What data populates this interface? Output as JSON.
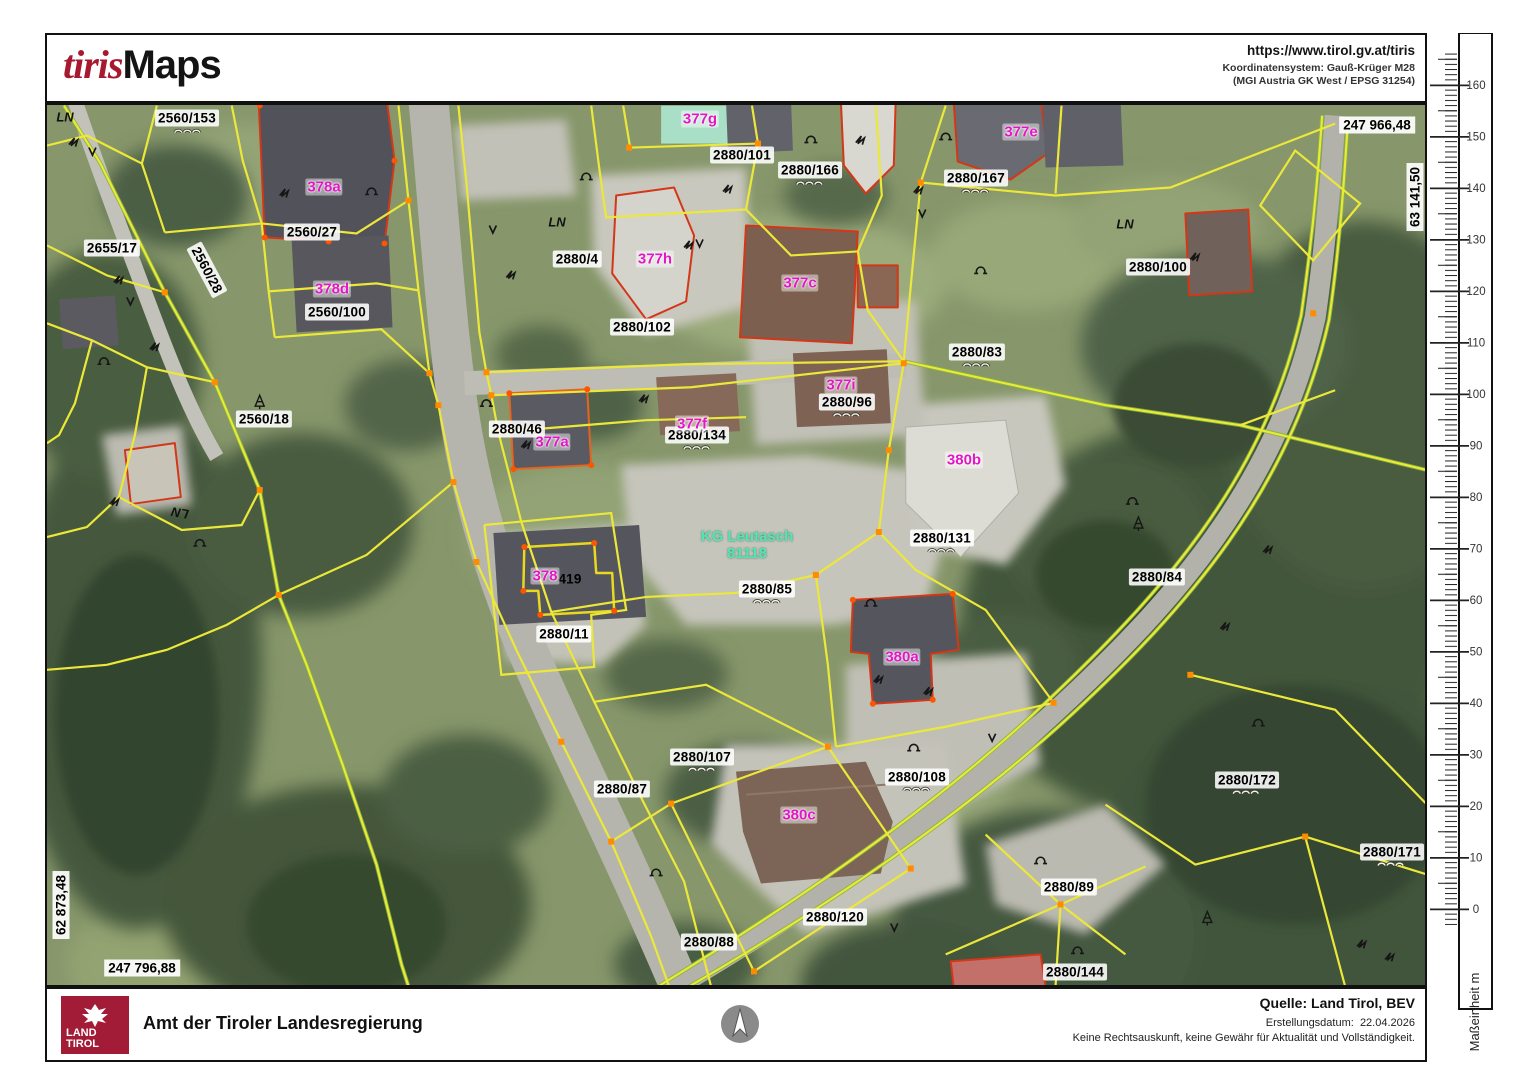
{
  "header": {
    "logo_tiris": "tiris",
    "logo_maps": "Maps",
    "url": "https://www.tirol.gv.at/tiris",
    "coord_system_line1": "Koordinatensystem: Gauß-Krüger M28",
    "coord_system_line2": "(MGI Austria GK West / EPSG 31254)"
  },
  "map": {
    "coords": {
      "top_right": "247 966,48",
      "right_edge": "63 141,50",
      "left_edge": "62 873,48",
      "bottom_left": "247 796,88"
    },
    "kg_label": {
      "line1": "KG Leutasch",
      "line2": "81118"
    },
    "ln_text": "LN",
    "parcel_labels": [
      {
        "text": "2560/153"
      },
      {
        "text": "2655/17"
      },
      {
        "text": "2560/28"
      },
      {
        "text": "2560/27"
      },
      {
        "text": "2560/100"
      },
      {
        "text": "2560/18"
      },
      {
        "text": "2880/4"
      },
      {
        "text": "2880/101"
      },
      {
        "text": "2880/166"
      },
      {
        "text": "2880/167"
      },
      {
        "text": "2880/102"
      },
      {
        "text": "2880/100"
      },
      {
        "text": "2880/83"
      },
      {
        "text": "2880/96"
      },
      {
        "text": "2880/46"
      },
      {
        "text": "2880/134"
      },
      {
        "text": "2880/131"
      },
      {
        "text": "2880/84"
      },
      {
        "text": "2880/85"
      },
      {
        "text": "2880/11"
      },
      {
        "text": "2880/107"
      },
      {
        "text": "2880/87"
      },
      {
        "text": "2880/108"
      },
      {
        "text": "2880/172"
      },
      {
        "text": "2880/171"
      },
      {
        "text": "2880/89"
      },
      {
        "text": "2880/120"
      },
      {
        "text": "2880/88"
      },
      {
        "text": "2880/144"
      },
      {
        "text": "419"
      }
    ],
    "building_labels": [
      {
        "text": "378a"
      },
      {
        "text": "378d"
      },
      {
        "text": "377g"
      },
      {
        "text": "377h"
      },
      {
        "text": "377c"
      },
      {
        "text": "377e"
      },
      {
        "text": "377i"
      },
      {
        "text": "377f"
      },
      {
        "text": "377a"
      },
      {
        "text": "378"
      },
      {
        "text": "380b"
      },
      {
        "text": "380a"
      },
      {
        "text": "380c"
      }
    ],
    "colors": {
      "parcel_line": "#ece83a",
      "parcel_line_green": "#84b63c",
      "building_outline_red": "#d43618",
      "vertex_orange": "#ff8c00",
      "building_label_magenta": "#e316c6",
      "kg_label_teal": "#4fe8b4"
    }
  },
  "scalebar": {
    "ticks": [
      "160",
      "150",
      "140",
      "130",
      "120",
      "110",
      "100",
      "90",
      "80",
      "70",
      "60",
      "50",
      "40",
      "30",
      "20",
      "10",
      "0"
    ],
    "unit_label": "Maßeinheit m"
  },
  "footer": {
    "logo_line1": "LAND",
    "logo_line2": "TIROL",
    "agency": "Amt der Tiroler Landesregierung",
    "source": "Quelle: Land Tirol, BEV",
    "date_label": "Erstellungsdatum:",
    "date_value": "22.04.2026",
    "disclaimer": "Keine Rechtsauskunft, keine Gewähr für Aktualität und Vollständigkeit."
  }
}
